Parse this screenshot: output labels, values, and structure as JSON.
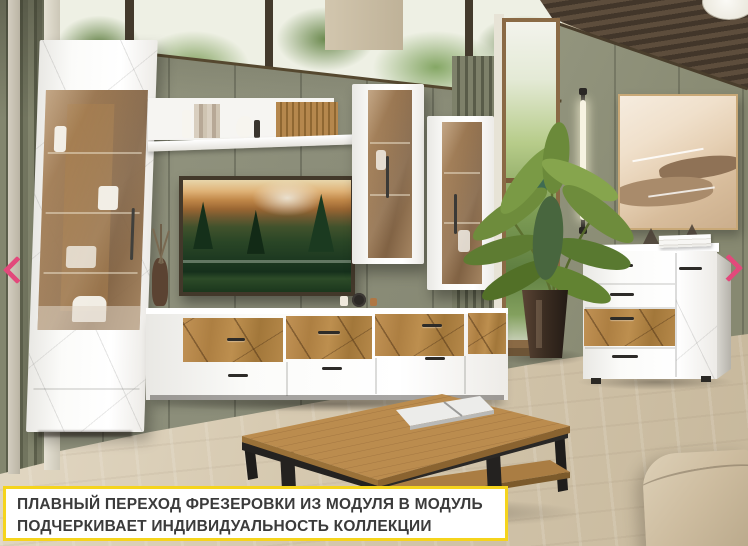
{
  "carousel": {
    "prev_icon": "chevron-left",
    "next_icon": "chevron-right",
    "arrow_color": "#e2497b"
  },
  "caption": {
    "line1": "ПЛАВНЫЙ ПЕРЕХОД ФРЕЗЕРОВКИ ИЗ МОДУЛЯ В МОДУЛЬ",
    "line2": "ПОДЧЕРКИВАЕТ ИНДИВИДУАЛЬНОСТЬ КОЛЛЕКЦИИ",
    "border_color": "#f5d41c",
    "background_color": "#ffffff",
    "text_color": "#3b3b3b"
  },
  "palette": {
    "wall_green": "#8c8e7a",
    "slat_wall_green": "#6c6f5a",
    "floor_wood": "#d5c9b0",
    "furniture_white": "#fbfbfa",
    "oak_wood": "#b08347",
    "glass_amber": "#a07a50",
    "metal_black": "#2d2b28",
    "ottoman_beige": "#cfbfa2",
    "ceiling_wood_dark": "#4e4133"
  }
}
